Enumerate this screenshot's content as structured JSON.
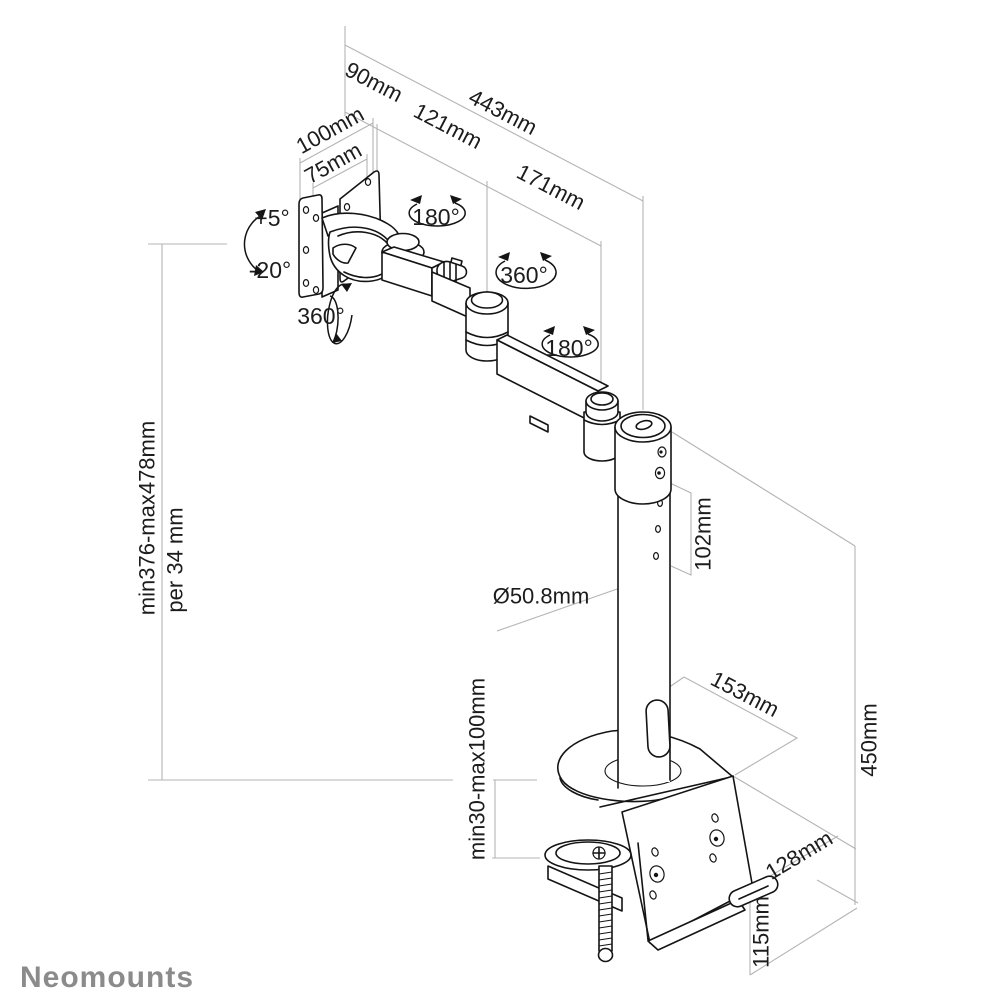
{
  "logo": {
    "text": "Neomounts",
    "color": "#8b8b8b"
  },
  "colors": {
    "line_art": "#141414",
    "dimension_lines": "#b4b4b4",
    "text": "#1c1c1c",
    "background": "#ffffff"
  },
  "dimensions": {
    "total_reach": "443mm",
    "vesa_depth": "90mm",
    "arm_segment_1": "121mm",
    "arm_segment_2": "171mm",
    "vesa_width_100": "100mm",
    "vesa_width_75": "75mm",
    "height_range": "min376-max478mm",
    "height_step": "per 34 mm",
    "pole_hole_span": "102mm",
    "pole_diameter": "Ø50.8mm",
    "base_depth": "153mm",
    "clamp_opening": "min30-max100mm",
    "pole_height": "450mm",
    "clamp_depth": "128mm",
    "clamp_height": "115mm"
  },
  "rotations": {
    "tilt_up": "+5°",
    "tilt_down": "-20°",
    "vesa_swivel": "360°",
    "arm_joint_1": "180°",
    "arm_joint_2": "360°",
    "arm_joint_3": "180°"
  }
}
